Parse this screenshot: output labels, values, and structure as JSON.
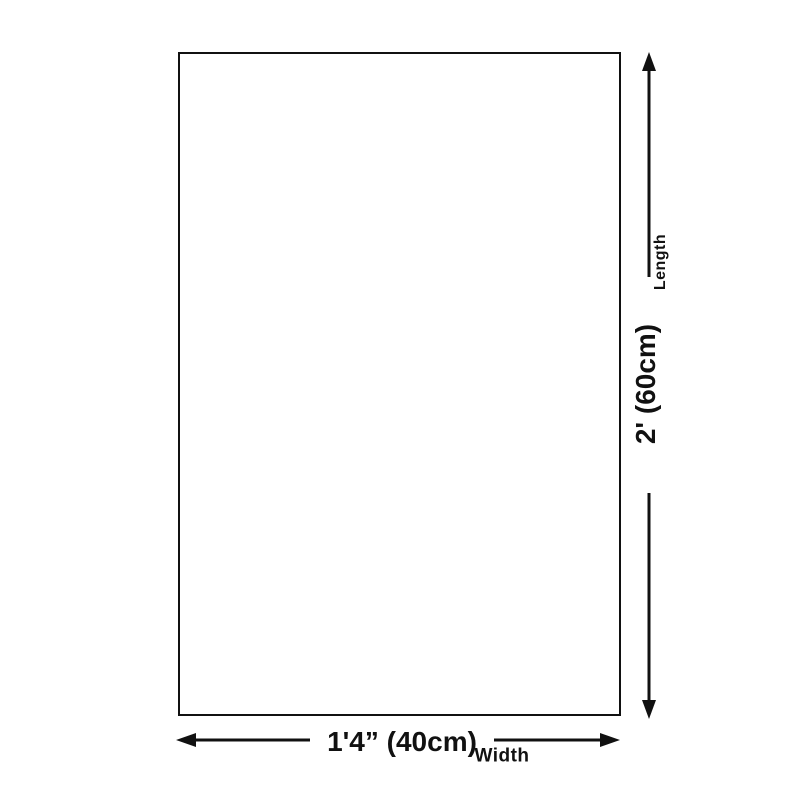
{
  "diagram": {
    "type": "product-dimension-diagram",
    "length_label": "Length",
    "length_value": "2' (60cm)",
    "width_value": "1'4” (40cm)",
    "width_label": "Width",
    "line_color": "#111111",
    "background_color": "#ffffff"
  }
}
